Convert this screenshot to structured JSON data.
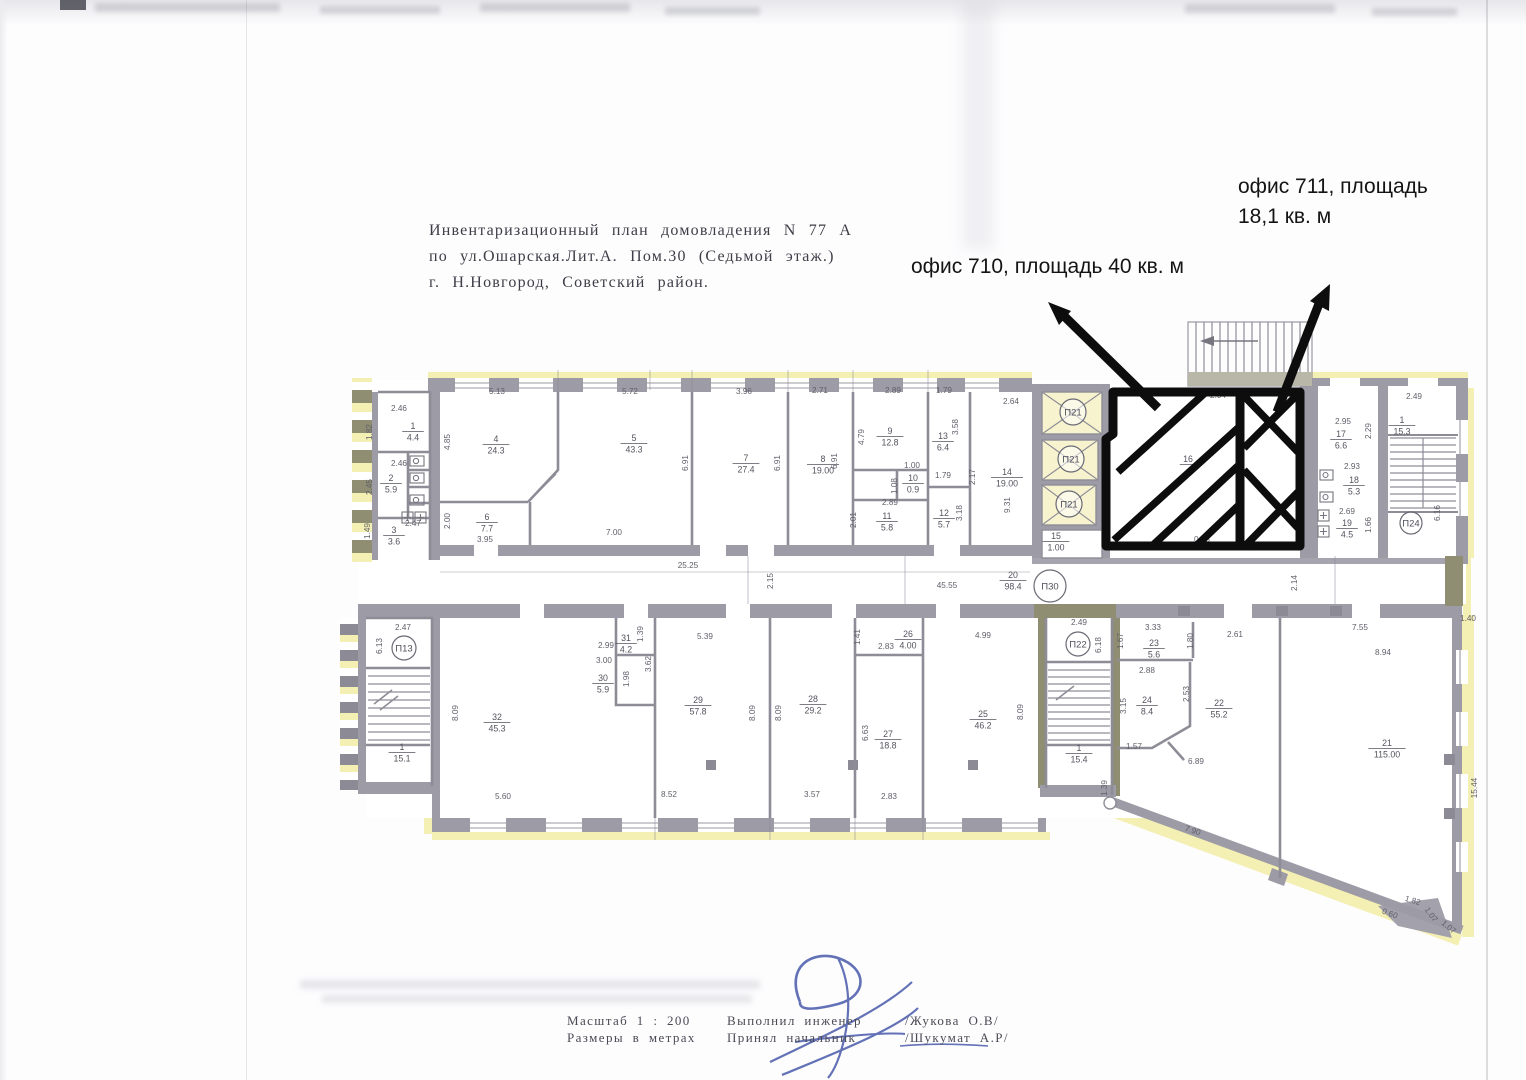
{
  "document": {
    "title_lines": [
      "Инвентаризационный план домовладения N 77 А",
      "по ул.Ошарская.Лит.А. Пом.30 (Седьмой этаж.)",
      "г. Н.Новгород, Советский район."
    ],
    "annotations": {
      "office_711_line1": "офис 711, площадь",
      "office_711_line2": "18,1 кв. м",
      "office_710_text": "офис 710, площадь 40 кв. м"
    },
    "footer": {
      "scale": "Масштаб 1 : 200",
      "units": "Размеры в метрах",
      "performed_label": "Выполнил инженер",
      "performed_name": "/Жукова О.В/",
      "accepted_label": "Принял начальник",
      "accepted_name": "/Шукумат А.Р/"
    }
  },
  "plan": {
    "colors": {
      "wall": "#9d9ca6",
      "olive": "#8f8d72",
      "yellow": "#f4efb2",
      "highlight": "#0d0d0d",
      "ink": "#5f5f6a",
      "pen": "#3d4fa5"
    },
    "circles": [
      {
        "t": "П13",
        "x": 404,
        "y": 648,
        "rr": 12
      },
      {
        "t": "П21",
        "x": 1073,
        "y": 412,
        "rr": 13
      },
      {
        "t": "П21",
        "x": 1071,
        "y": 459,
        "rr": 13
      },
      {
        "t": "П21",
        "x": 1069,
        "y": 504,
        "rr": 13
      },
      {
        "t": "П22",
        "x": 1078,
        "y": 644,
        "rr": 12
      },
      {
        "t": "П24",
        "x": 1411,
        "y": 523,
        "rr": 11
      },
      {
        "t": "П30",
        "x": 1050,
        "y": 586,
        "rr": 16
      }
    ],
    "rooms": [
      {
        "n": "1",
        "a": "4.4",
        "x": 413,
        "y": 429
      },
      {
        "n": "2",
        "a": "5.9",
        "x": 391,
        "y": 481
      },
      {
        "n": "3",
        "a": "3.6",
        "x": 394,
        "y": 533
      },
      {
        "n": "4",
        "a": "24.3",
        "x": 496,
        "y": 442
      },
      {
        "n": "5",
        "a": "43.3",
        "x": 634,
        "y": 441
      },
      {
        "n": "6",
        "a": "7.7",
        "x": 487,
        "y": 520
      },
      {
        "n": "7",
        "a": "27.4",
        "x": 746,
        "y": 461
      },
      {
        "n": "8",
        "a": "19.00",
        "x": 823,
        "y": 462
      },
      {
        "n": "9",
        "a": "12.8",
        "x": 890,
        "y": 434
      },
      {
        "n": "10",
        "a": "0.9",
        "x": 913,
        "y": 481
      },
      {
        "n": "11",
        "a": "5.8",
        "x": 887,
        "y": 519
      },
      {
        "n": "12",
        "a": "5.7",
        "x": 944,
        "y": 516
      },
      {
        "n": "13",
        "a": "6.4",
        "x": 943,
        "y": 439
      },
      {
        "n": "14",
        "a": "19.00",
        "x": 1007,
        "y": 475
      },
      {
        "n": "15",
        "a": "1.00",
        "x": 1056,
        "y": 539
      },
      {
        "n": "16",
        "a": "",
        "x": 1188,
        "y": 462
      },
      {
        "n": "17",
        "a": "6.6",
        "x": 1341,
        "y": 437
      },
      {
        "n": "18",
        "a": "5.3",
        "x": 1354,
        "y": 483
      },
      {
        "n": "19",
        "a": "4.5",
        "x": 1347,
        "y": 526
      },
      {
        "n": "1",
        "a": "15.3",
        "x": 1402,
        "y": 423
      },
      {
        "n": "20",
        "a": "98.4",
        "x": 1013,
        "y": 578
      },
      {
        "n": "1",
        "a": "15.1",
        "x": 402,
        "y": 750
      },
      {
        "n": "32",
        "a": "45.3",
        "x": 497,
        "y": 720
      },
      {
        "n": "31",
        "a": "4.2",
        "x": 626,
        "y": 641
      },
      {
        "n": "30",
        "a": "5.9",
        "x": 603,
        "y": 681
      },
      {
        "n": "29",
        "a": "57.8",
        "x": 698,
        "y": 703
      },
      {
        "n": "28",
        "a": "29.2",
        "x": 813,
        "y": 702
      },
      {
        "n": "27",
        "a": "18.8",
        "x": 888,
        "y": 737
      },
      {
        "n": "26",
        "a": "4.00",
        "x": 908,
        "y": 637
      },
      {
        "n": "25",
        "a": "46.2",
        "x": 983,
        "y": 717
      },
      {
        "n": "1",
        "a": "15.4",
        "x": 1079,
        "y": 751
      },
      {
        "n": "23",
        "a": "5.6",
        "x": 1154,
        "y": 646
      },
      {
        "n": "24",
        "a": "8.4",
        "x": 1147,
        "y": 703
      },
      {
        "n": "22",
        "a": "55.2",
        "x": 1219,
        "y": 706
      },
      {
        "n": "21",
        "a": "115.00",
        "x": 1387,
        "y": 746
      }
    ],
    "dims": [
      {
        "t": "5.13",
        "x": 497,
        "y": 394
      },
      {
        "t": "5.72",
        "x": 630,
        "y": 394
      },
      {
        "t": "3.96",
        "x": 744,
        "y": 394
      },
      {
        "t": "2.71",
        "x": 820,
        "y": 393
      },
      {
        "t": "2.89",
        "x": 893,
        "y": 393
      },
      {
        "t": "1.79",
        "x": 944,
        "y": 393
      },
      {
        "t": "2.64",
        "x": 1011,
        "y": 404
      },
      {
        "t": "2.46",
        "x": 399,
        "y": 411
      },
      {
        "t": "1.82",
        "x": 372,
        "y": 432,
        "r": -90
      },
      {
        "t": "2.46",
        "x": 399,
        "y": 466
      },
      {
        "t": "2.45",
        "x": 372,
        "y": 487,
        "r": -90
      },
      {
        "t": "2.47",
        "x": 413,
        "y": 526
      },
      {
        "t": "1.49",
        "x": 370,
        "y": 531,
        "r": -90
      },
      {
        "t": "4.85",
        "x": 450,
        "y": 442,
        "r": -90
      },
      {
        "t": "2.00",
        "x": 450,
        "y": 521,
        "r": -90
      },
      {
        "t": "3.95",
        "x": 485,
        "y": 542
      },
      {
        "t": "7.00",
        "x": 614,
        "y": 535
      },
      {
        "t": "6.91",
        "x": 688,
        "y": 463,
        "r": -90
      },
      {
        "t": "6.91",
        "x": 780,
        "y": 463,
        "r": -90
      },
      {
        "t": "6.91",
        "x": 837,
        "y": 461,
        "r": -90
      },
      {
        "t": "4.79",
        "x": 864,
        "y": 437,
        "r": -90
      },
      {
        "t": "1.00",
        "x": 912,
        "y": 468
      },
      {
        "t": "1.08",
        "x": 897,
        "y": 486,
        "r": -90
      },
      {
        "t": "2.89",
        "x": 890,
        "y": 505
      },
      {
        "t": "2.01",
        "x": 856,
        "y": 520,
        "r": -90
      },
      {
        "t": "1.79",
        "x": 943,
        "y": 478
      },
      {
        "t": "3.58",
        "x": 958,
        "y": 427,
        "r": -90
      },
      {
        "t": "2.17",
        "x": 975,
        "y": 477,
        "r": -90
      },
      {
        "t": "3.18",
        "x": 962,
        "y": 513,
        "r": -90
      },
      {
        "t": "9.31",
        "x": 1010,
        "y": 505,
        "r": -90
      },
      {
        "t": "2.04",
        "x": 1218,
        "y": 398,
        "fs": 7
      },
      {
        "t": "0.58",
        "x": 1202,
        "y": 542,
        "fs": 7
      },
      {
        "t": "2.95",
        "x": 1343,
        "y": 424
      },
      {
        "t": "2.29",
        "x": 1371,
        "y": 431,
        "r": -90
      },
      {
        "t": "2.93",
        "x": 1352,
        "y": 469
      },
      {
        "t": "2.69",
        "x": 1347,
        "y": 514
      },
      {
        "t": "1.66",
        "x": 1371,
        "y": 525,
        "r": -90
      },
      {
        "t": "6.16",
        "x": 1440,
        "y": 513,
        "r": -90
      },
      {
        "t": "2.49",
        "x": 1414,
        "y": 399
      },
      {
        "t": "25.25",
        "x": 688,
        "y": 568
      },
      {
        "t": "2.15",
        "x": 773,
        "y": 581,
        "r": -90
      },
      {
        "t": "45.55",
        "x": 947,
        "y": 588
      },
      {
        "t": "2.14",
        "x": 1297,
        "y": 583,
        "r": -90
      },
      {
        "t": "2.47",
        "x": 403,
        "y": 630
      },
      {
        "t": "6.13",
        "x": 382,
        "y": 646,
        "r": -90
      },
      {
        "t": "8.09",
        "x": 458,
        "y": 713,
        "r": -90
      },
      {
        "t": "5.60",
        "x": 503,
        "y": 799
      },
      {
        "t": "2.99",
        "x": 606,
        "y": 648
      },
      {
        "t": "1.39",
        "x": 643,
        "y": 634,
        "r": -90,
        "fs": 7
      },
      {
        "t": "3.00",
        "x": 604,
        "y": 663
      },
      {
        "t": "1.98",
        "x": 629,
        "y": 679,
        "r": -90
      },
      {
        "t": "3.62",
        "x": 651,
        "y": 664,
        "r": -90
      },
      {
        "t": "5.39",
        "x": 705,
        "y": 639
      },
      {
        "t": "8.09",
        "x": 755,
        "y": 713,
        "r": -90
      },
      {
        "t": "8.09",
        "x": 781,
        "y": 713,
        "r": -90
      },
      {
        "t": "8.52",
        "x": 669,
        "y": 797
      },
      {
        "t": "3.57",
        "x": 812,
        "y": 797
      },
      {
        "t": "6.63",
        "x": 868,
        "y": 733,
        "r": -90
      },
      {
        "t": "2.83",
        "x": 889,
        "y": 799
      },
      {
        "t": "1.41",
        "x": 860,
        "y": 637,
        "r": -90,
        "fs": 7
      },
      {
        "t": "2.83",
        "x": 886,
        "y": 649
      },
      {
        "t": "4.99",
        "x": 983,
        "y": 638
      },
      {
        "t": "8.09",
        "x": 1023,
        "y": 712,
        "r": -90
      },
      {
        "t": "2.49",
        "x": 1079,
        "y": 625
      },
      {
        "t": "6.18",
        "x": 1101,
        "y": 645,
        "r": -90
      },
      {
        "t": "3.33",
        "x": 1153,
        "y": 630
      },
      {
        "t": "1.67",
        "x": 1123,
        "y": 641,
        "r": -90
      },
      {
        "t": "1.80",
        "x": 1193,
        "y": 641,
        "r": -90
      },
      {
        "t": "2.61",
        "x": 1235,
        "y": 637
      },
      {
        "t": "2.88",
        "x": 1147,
        "y": 673
      },
      {
        "t": "3.15",
        "x": 1126,
        "y": 706,
        "r": -90
      },
      {
        "t": "2.53",
        "x": 1189,
        "y": 694,
        "r": -90
      },
      {
        "t": "1.57",
        "x": 1134,
        "y": 749
      },
      {
        "t": "6.89",
        "x": 1196,
        "y": 764
      },
      {
        "t": "7.55",
        "x": 1360,
        "y": 630
      },
      {
        "t": "8.94",
        "x": 1383,
        "y": 655
      },
      {
        "t": "1.40",
        "x": 1468,
        "y": 621,
        "fs": 7
      },
      {
        "t": "15.44",
        "x": 1477,
        "y": 788,
        "r": -90
      },
      {
        "t": "7.90",
        "x": 1192,
        "y": 833,
        "r": 18
      },
      {
        "t": "1.39",
        "x": 1107,
        "y": 788,
        "r": -90,
        "fs": 7
      },
      {
        "t": "0.60",
        "x": 1389,
        "y": 916,
        "r": 20,
        "fs": 7
      },
      {
        "t": "1.82",
        "x": 1412,
        "y": 903,
        "r": 17,
        "fs": 7
      },
      {
        "t": "1.07",
        "x": 1429,
        "y": 916,
        "r": 55,
        "fs": 7
      },
      {
        "t": "1.07",
        "x": 1447,
        "y": 929,
        "r": 40,
        "fs": 7
      }
    ]
  }
}
